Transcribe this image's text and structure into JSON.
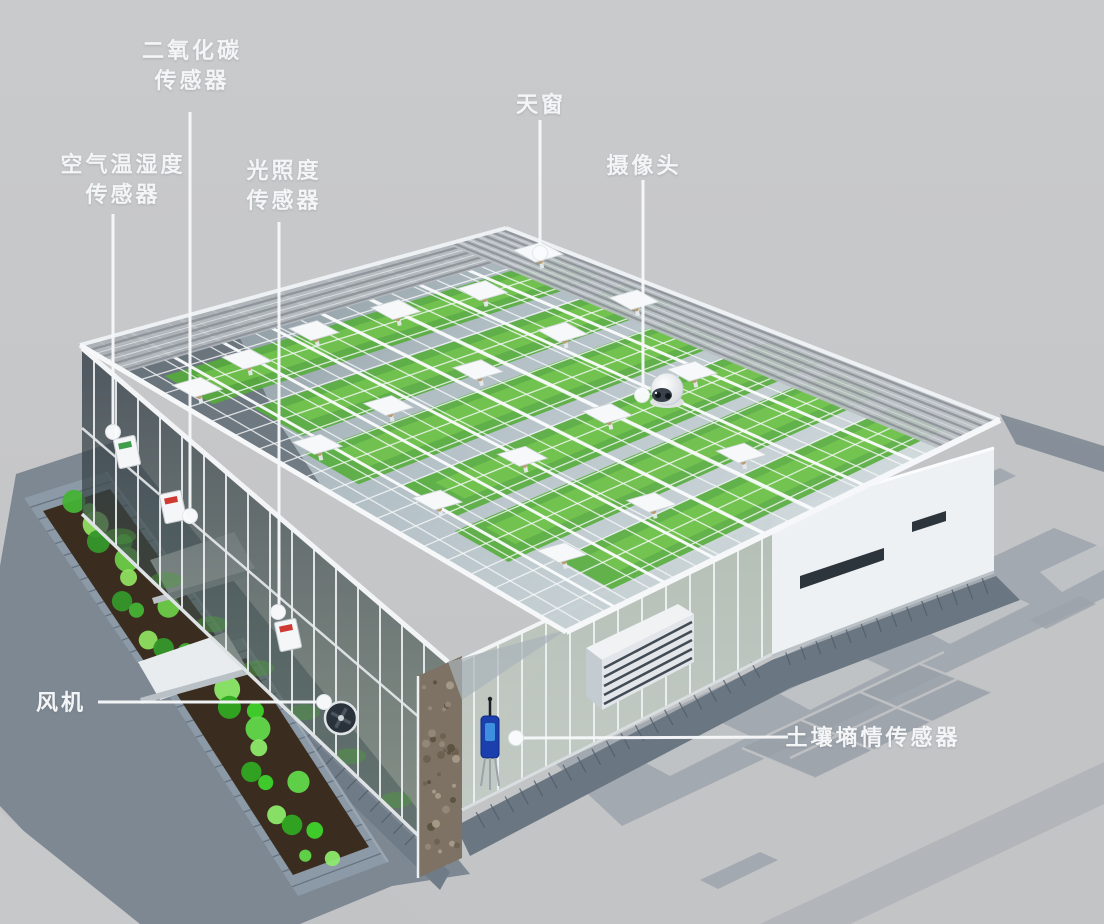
{
  "figure_type": "smart-greenhouse-sensor-diagram",
  "labels": {
    "co2_sensor": {
      "line1": "二氧化碳",
      "line2": "传感器"
    },
    "air_temp_humidity_sensor": {
      "line1": "空气温湿度",
      "line2": "传感器"
    },
    "light_sensor": {
      "line1": "光照度",
      "line2": "传感器"
    },
    "skylight": {
      "text": "天窗"
    },
    "camera": {
      "text": "摄像头"
    },
    "fan": {
      "text": "风机"
    },
    "soil_moisture_sensor": {
      "text": "土壤墒情传感器"
    }
  },
  "palette": {
    "background": "#c5c6c8",
    "label_text": "#f3f5f7",
    "leader_line": "#f6f8fa",
    "leader_dot": "#fafcfd",
    "structure_white": "#f2f4f6",
    "glass_tint": "#cfd9dd",
    "crop_green": "#54ad39",
    "leaf_green": "#52d636",
    "paving_light": "#c2c4c6",
    "paving_dark": "#9ba2aa",
    "slate_gray": "#7d8893",
    "soil_brown": "#3a2d20",
    "sensor_device_blue": "#1c3fae",
    "sensor_stripe_red": "#cf3b33",
    "sensor_stripe_green": "#3f9e4a"
  }
}
